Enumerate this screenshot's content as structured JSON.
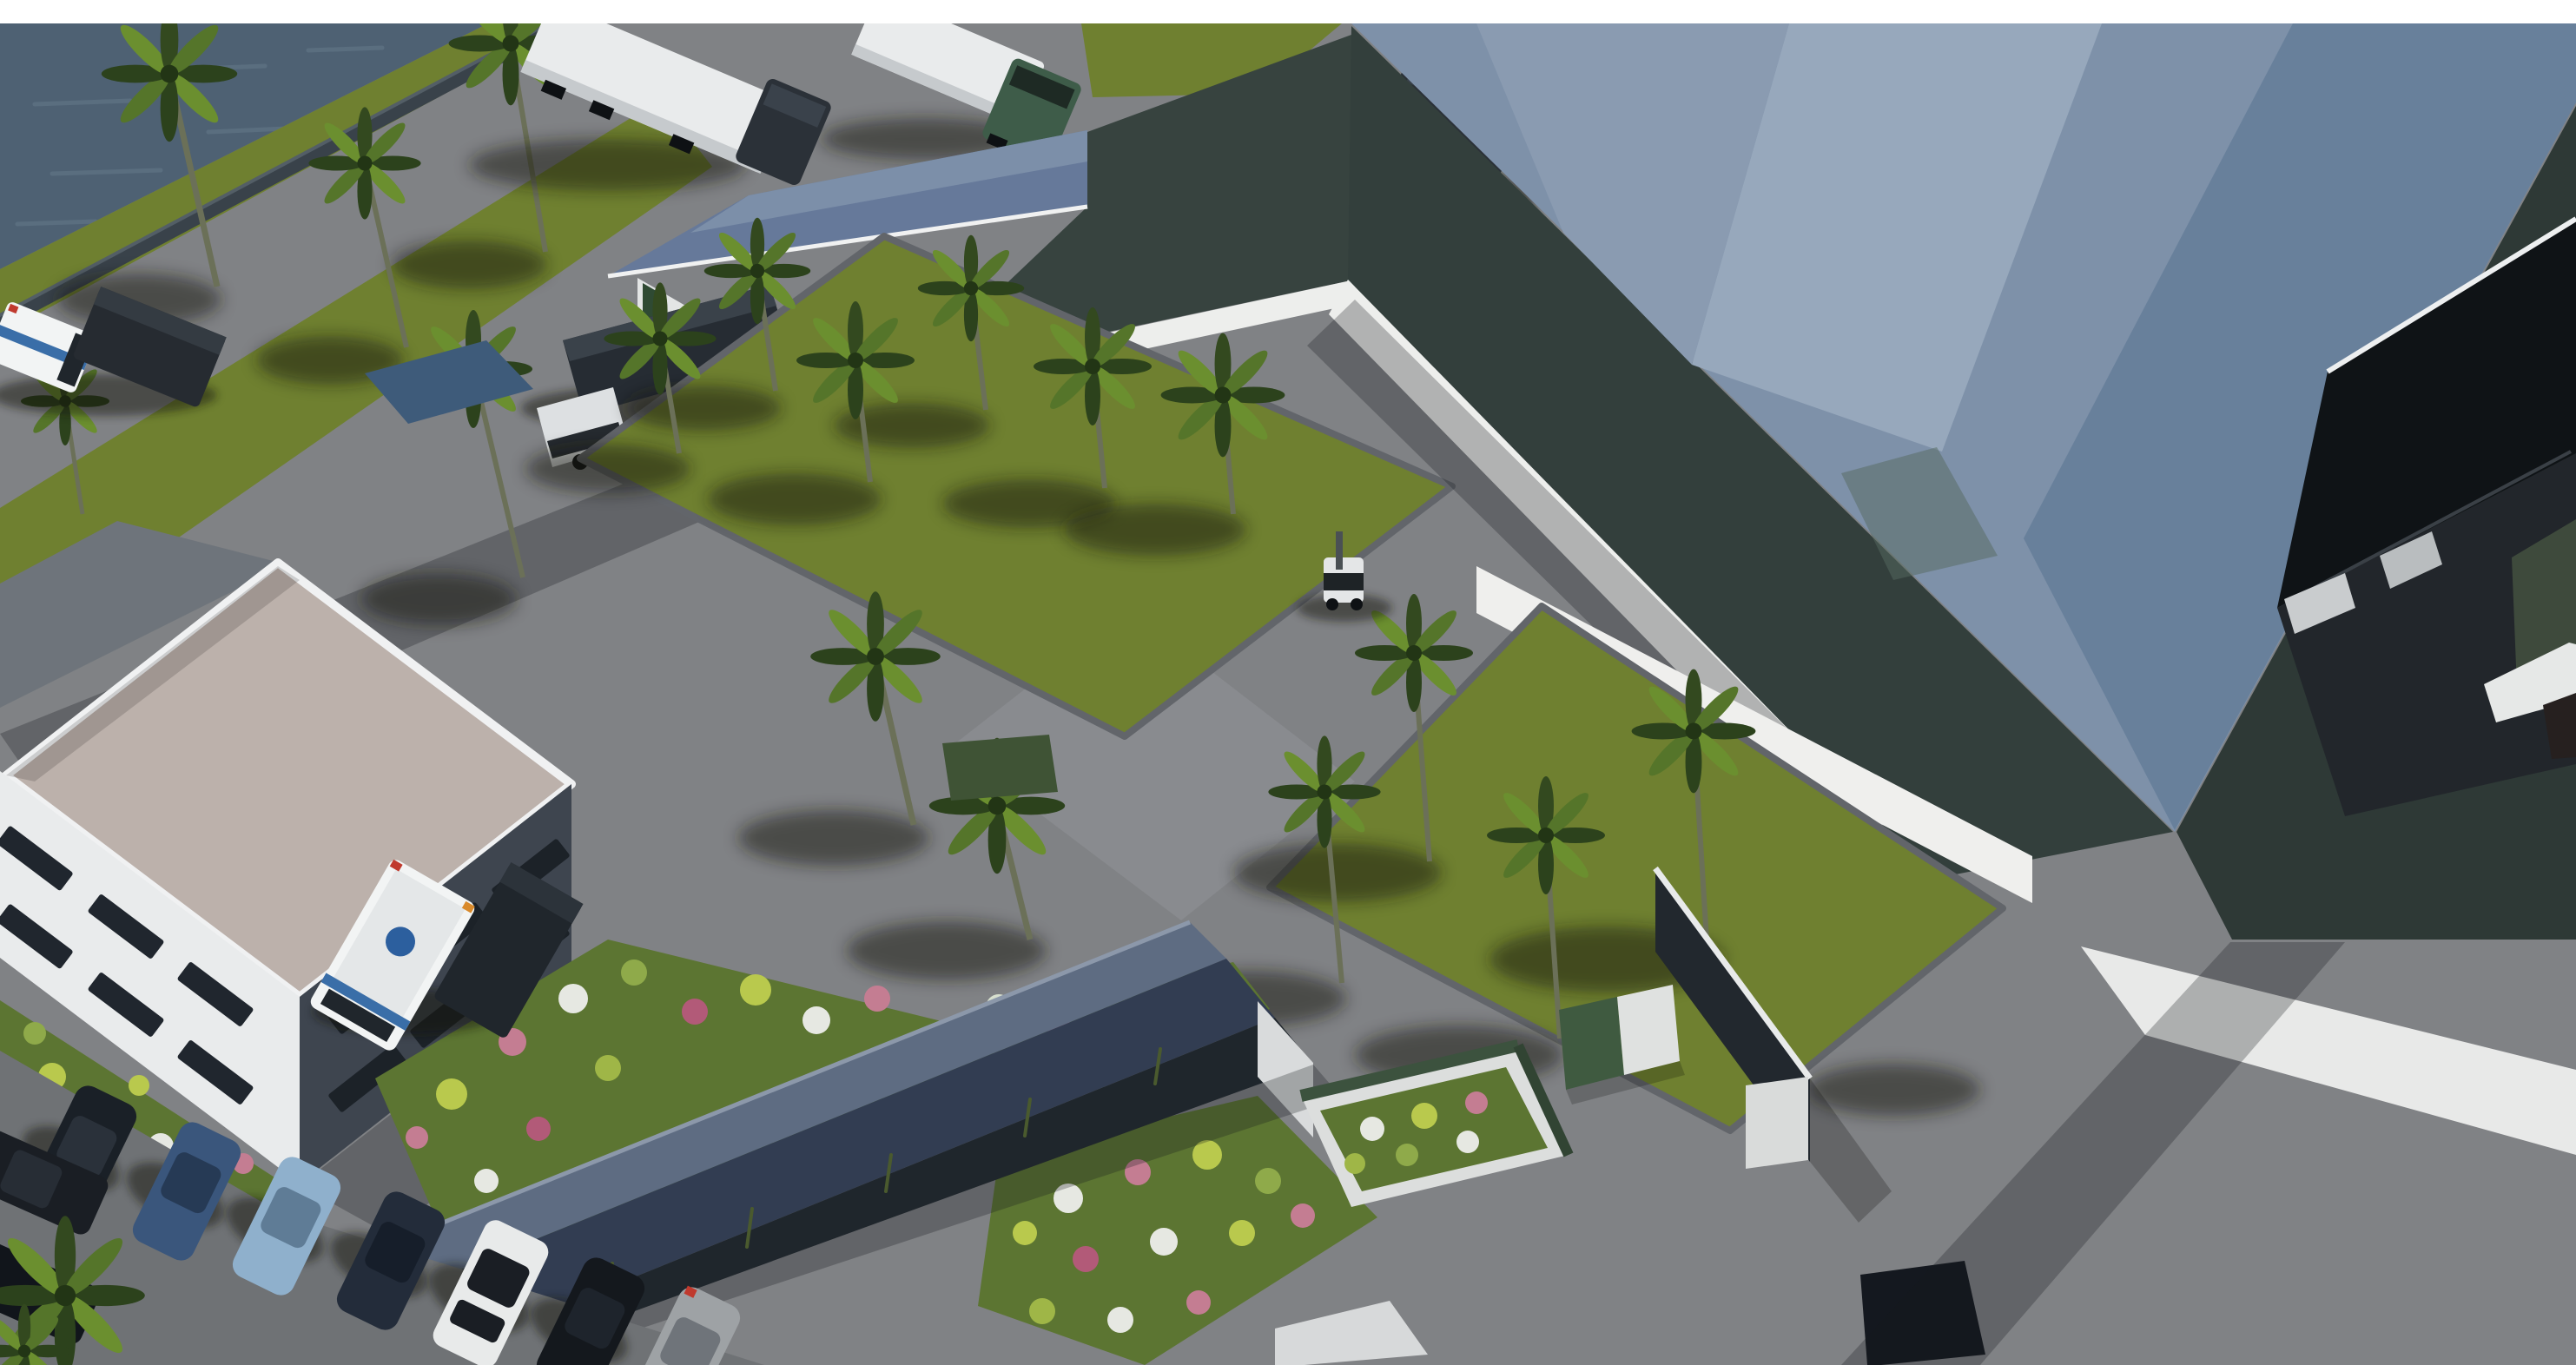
{
  "scene": {
    "type": "3d-architectural-rendering",
    "view": "aerial-three-quarter",
    "setting": "waterfront industrial logistics campus with palm trees",
    "top_margin_label": "white letterbox strip"
  },
  "colors": {
    "topStrip": "#FFFFFF",
    "water": "#4E6173",
    "ripple": "#64798A",
    "grass": "#6F8030",
    "asphalt": "#808285",
    "asphaltLight": "#8B8D90",
    "asphaltDark": "#6F7275",
    "quayWall": "#39424A",
    "quayWallTop": "#535E66",
    "trailerWhite": "#E9EBEC",
    "cabDark": "#2B3138",
    "cabGreen": "#3E5C49",
    "warehouseRoof": "#7E91A9",
    "warehouseRoofLight": "#97A8BC",
    "warehouseRoofMid": "#8A9BB1",
    "warehouseRoofDark": "#68809B",
    "warehouseWallFront": "#333F3C",
    "warehouseWallWest": "#37433F",
    "warehouseWallEast": "#2E3936",
    "dockCanopy": "#0F1316",
    "dockShadow": "#22262B",
    "whiteTrim": "#EDEEEC",
    "wingRoof": "#66799A",
    "wingRoofTop": "#7C8FA9",
    "gatehouseWall": "#E3E5E5",
    "gatehouseDoor": "#8F969C",
    "signPanel": "#2F3A42",
    "signText": "#7FA8C9",
    "officeRoof": "#BCB1AB",
    "officeWallLit": "#E9EBEC",
    "officeWallShade": "#3E454F",
    "officeTier": "#6E747B",
    "longRoofLit": "#5E6C82",
    "longRoofDark": "#323D52",
    "longWall": "#1F262C",
    "longRidge": "#8C98AA",
    "endCapWhite": "#D9DBDC",
    "gardenBase": "#5C7532",
    "planterWhite": "#DCDEDD",
    "planterGreen": "#3C523E",
    "padGreen": "#3F5335",
    "bluePad": "#3E5B7A",
    "ambulanceBody": "#F2F4F4",
    "ambulanceBlue": "#2C5F9E",
    "ambulanceStripe": "#3A6EA8",
    "alertRed": "#C03A2E",
    "carBlack": "#14181D",
    "carNavy": "#232C3A",
    "carSteelBlue": "#3A567C",
    "carLightBlue": "#8FB0CC",
    "carWhite": "#E8EAEA",
    "carGray": "#9EA2A5",
    "darkMat": "#14181F",
    "palmTrunk": "#6B7058",
    "palmFrondDark": "#2C421C",
    "palmFrondLight": "#6B8F2F",
    "wedgeGreen": "#3E4A3C"
  },
  "objects": {
    "water": {
      "label": "harbor water with ripples"
    },
    "quayWall": {
      "label": "dark perimeter wall along waterfront lawn"
    },
    "palmTrees": {
      "count": 19
    },
    "lawns": {
      "count": 3,
      "labels": [
        "waterfront lawn",
        "left courtyard lawn",
        "right courtyard lawn"
      ]
    },
    "buildings": {
      "warehouse": {
        "label": "large warehouse with stepped blue-gray roof and loading dock"
      },
      "wing": {
        "label": "low entrance wing with blue-gray roof and white gatehouse wall"
      },
      "office": {
        "label": "white two-story office block with beige flat roof"
      },
      "longHall": {
        "label": "long gabled hall with two-tone blue roof"
      }
    },
    "vehicles": {
      "semiTrucks": [
        {
          "trailer": "white",
          "cab": "dark gray"
        },
        {
          "trailer": "white",
          "cab": "green"
        },
        {
          "trailer": "dark",
          "top": "white"
        },
        {
          "trailer": "dark",
          "cab": "white",
          "location": "gatehouse blue pad"
        }
      ],
      "ambulances": [
        {
          "location": "quay road, top-left"
        },
        {
          "location": "office courtyard, star-of-life roof decal"
        }
      ],
      "parkedCars": [
        {
          "color": "black"
        },
        {
          "color": "steel blue"
        },
        {
          "color": "light blue"
        },
        {
          "color": "navy"
        },
        {
          "color": "white van"
        },
        {
          "color": "black"
        },
        {
          "color": "gray"
        }
      ],
      "forklift": {
        "location": "near warehouse west corner"
      }
    },
    "gardens": {
      "count": 4,
      "label": "flower beds with pink / white / yellow-green planting"
    },
    "planter": {
      "label": "white raised planter box with green back wall"
    }
  }
}
